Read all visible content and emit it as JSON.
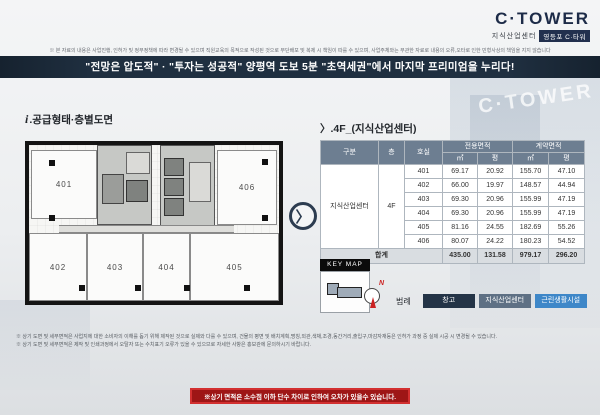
{
  "logo": {
    "title": "C·TOWER",
    "subtitle": "지식산업센터",
    "badge": "영등포 C·타워"
  },
  "top_disclaimer": "※ 본 자료의 내용은 사업진행, 인허가 및 정부정책에 따라 변경될 수 있으며 직원교육의 목적으로 작성된 것으로 무단배포 및 복제 시 책임이 따를 수 있으며, 사업주체와는 무관한 자료로 내용의 오류,오타로 인한 민형사상의 책임을 지지 않습니다",
  "banner": "\"전망은 압도적\" · \"투자는 성공적\" 양평역 도보 5분 \"초역세권\"에서 마지막 프리미엄을 누리다!",
  "left": {
    "heading_icon": "i",
    "heading": ".공급형태·층별도면",
    "units": [
      "401",
      "402",
      "403",
      "404",
      "405",
      "406"
    ]
  },
  "chevron": "〉",
  "right": {
    "heading_icon": "〉",
    "heading": ".4F_(지식산업센터)",
    "table": {
      "col_gubun": "구분",
      "col_floor": "층",
      "col_room": "호실",
      "col_exclusive": "전용면적",
      "col_contract": "계약면적",
      "col_m2": "㎡",
      "col_py": "평",
      "category": "지식산업센터",
      "floor": "4F",
      "rows": [
        {
          "room": "401",
          "ex_m2": "69.17",
          "ex_py": "20.92",
          "ct_m2": "155.70",
          "ct_py": "47.10"
        },
        {
          "room": "402",
          "ex_m2": "66.00",
          "ex_py": "19.97",
          "ct_m2": "148.57",
          "ct_py": "44.94"
        },
        {
          "room": "403",
          "ex_m2": "69.30",
          "ex_py": "20.96",
          "ct_m2": "155.99",
          "ct_py": "47.19"
        },
        {
          "room": "404",
          "ex_m2": "69.30",
          "ex_py": "20.96",
          "ct_m2": "155.99",
          "ct_py": "47.19"
        },
        {
          "room": "405",
          "ex_m2": "81.16",
          "ex_py": "24.55",
          "ct_m2": "182.69",
          "ct_py": "55.26"
        },
        {
          "room": "406",
          "ex_m2": "80.07",
          "ex_py": "24.22",
          "ct_m2": "180.23",
          "ct_py": "54.52"
        }
      ],
      "total": {
        "label": "합계",
        "ex_m2": "435.00",
        "ex_py": "131.58",
        "ct_m2": "979.17",
        "ct_py": "296.20"
      }
    },
    "keymap_label": "KEY MAP",
    "compass_label": "N",
    "legend": {
      "label": "범례",
      "items": [
        {
          "name": "창고",
          "color": "#243447"
        },
        {
          "name": "지식산업센터",
          "color": "#5e7084"
        },
        {
          "name": "근린생활시설",
          "color": "#3e87c8"
        }
      ]
    }
  },
  "footnotes": {
    "line1": "※ 상기 도면 및 세부면적은 사업지에 대한 소비자의 이해를 돕기 위해 제작된 것으로 실제와 다를 수 있으며, 건물의 평면 및 배치계획,명칭,외관,색채,조경,동간거리,출입구,마감자재등은 인허가 과정 중 실제 시공 시 변경될 수 있습니다.",
    "line2": "※ 상기 도면 및 세부면적은 제작 및 인쇄과정에서 오탈자 또는 수치표기 오류가 있을 수 있으므로 자세한 사항은 홍보관에 문의하시기 바랍니다."
  },
  "bottom_banner": "※상기 면적은 소수점 이하 단수 차이로 인하여 오차가 있을수 있습니다."
}
